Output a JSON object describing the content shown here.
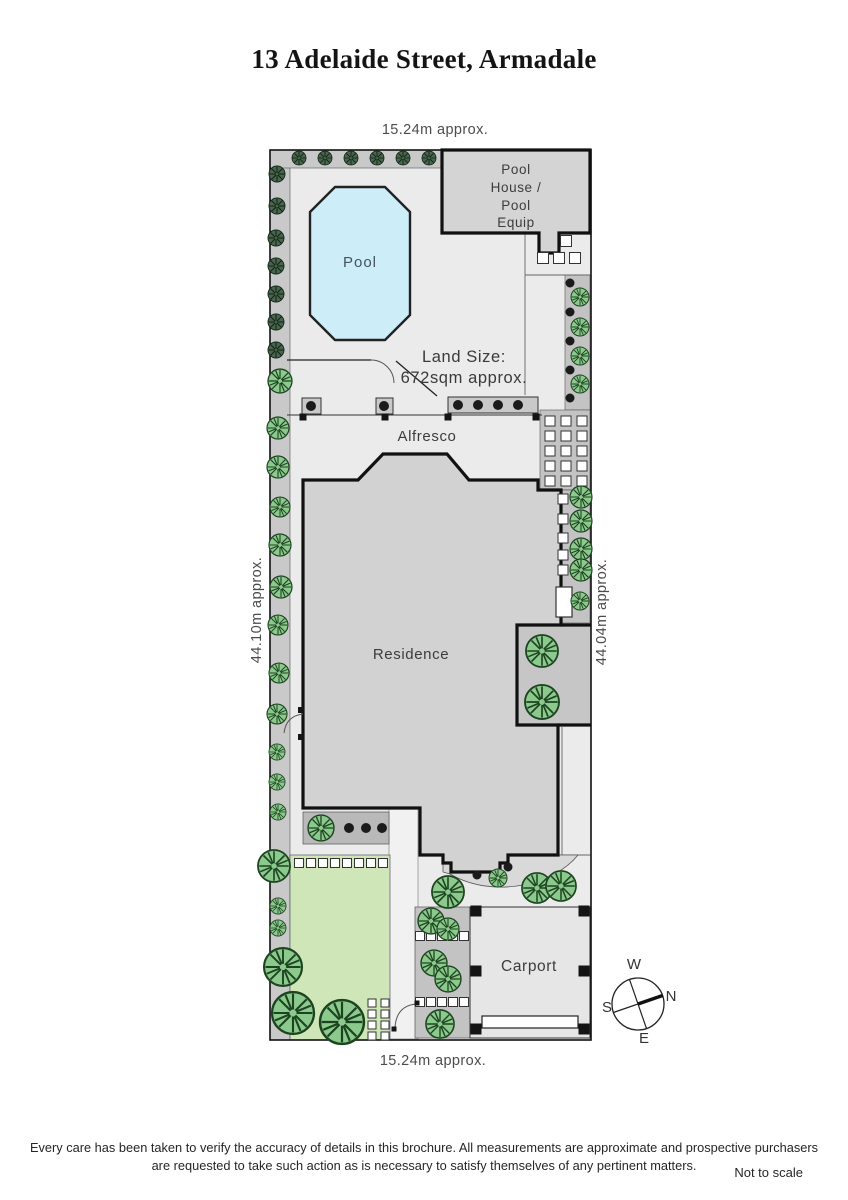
{
  "title": "13 Adelaide Street, Armadale",
  "dimensions": {
    "top": "15.24m approx.",
    "bottom": "15.24m approx.",
    "left": "44.10m approx.",
    "right": "44.04m approx."
  },
  "labels": {
    "pool": "Pool",
    "pool_house": "Pool\nHouse /\nPool\nEquip",
    "land_size": "Land Size:\n672sqm approx.",
    "alfresco": "Alfresco",
    "residence": "Residence",
    "carport": "Carport"
  },
  "compass": {
    "w": "W",
    "n": "N",
    "s": "S",
    "e": "E"
  },
  "footer": {
    "disclaimer": "Every care has been taken to verify the accuracy of details in this brochure.  All measurements are approximate and prospective purchasers\nare requested to take such action as is necessary to satisfy themselves of any pertinent matters.",
    "scale_note": "Not to scale"
  },
  "colors": {
    "ground": "#ebebeb",
    "boundary_strip": "#c9c9c9",
    "building": "#d2d2d2",
    "pool_water": "#cdeef8",
    "lawn": "#cfe6b8",
    "courtyard": "#c6c6c6",
    "garden_bed": "#b9b9b9",
    "tree_green": "#8cc98c",
    "tree_dark": "#49654e",
    "outline": "#111111"
  },
  "plan": {
    "trees": [
      [
        299,
        158,
        7,
        "d"
      ],
      [
        325,
        158,
        7,
        "d"
      ],
      [
        351,
        158,
        7,
        "d"
      ],
      [
        377,
        158,
        7,
        "d"
      ],
      [
        403,
        158,
        7,
        "d"
      ],
      [
        429,
        158,
        7,
        "d"
      ],
      [
        277,
        174,
        8,
        "d"
      ],
      [
        277,
        206,
        8,
        "d"
      ],
      [
        276,
        238,
        8,
        "d"
      ],
      [
        276,
        266,
        8,
        "d"
      ],
      [
        276,
        294,
        8,
        "d"
      ],
      [
        276,
        322,
        8,
        "d"
      ],
      [
        276,
        350,
        8,
        "d"
      ],
      [
        280,
        381,
        12,
        "g"
      ],
      [
        278,
        428,
        11,
        "g"
      ],
      [
        278,
        467,
        11,
        "g"
      ],
      [
        280,
        507,
        10,
        "g"
      ],
      [
        280,
        545,
        11,
        "g"
      ],
      [
        281,
        587,
        11,
        "g"
      ],
      [
        278,
        625,
        10,
        "g"
      ],
      [
        279,
        673,
        10,
        "g"
      ],
      [
        277,
        714,
        10,
        "g"
      ],
      [
        277,
        752,
        8,
        "g"
      ],
      [
        277,
        782,
        8,
        "g"
      ],
      [
        278,
        812,
        8,
        "g"
      ],
      [
        274,
        866,
        16,
        "g"
      ],
      [
        278,
        906,
        8,
        "g"
      ],
      [
        278,
        928,
        8,
        "g"
      ],
      [
        283,
        967,
        19,
        "g"
      ],
      [
        293,
        1013,
        21,
        "g"
      ],
      [
        342,
        1022,
        22,
        "g"
      ],
      [
        321,
        828,
        13,
        "g"
      ],
      [
        580,
        297,
        9,
        "g"
      ],
      [
        580,
        327,
        9,
        "g"
      ],
      [
        580,
        356,
        9,
        "g"
      ],
      [
        580,
        384,
        9,
        "g"
      ],
      [
        581,
        497,
        11,
        "g"
      ],
      [
        581,
        521,
        11,
        "g"
      ],
      [
        581,
        549,
        11,
        "g"
      ],
      [
        581,
        570,
        11,
        "g"
      ],
      [
        580,
        601,
        9,
        "g"
      ],
      [
        542,
        651,
        16,
        "g"
      ],
      [
        542,
        702,
        17,
        "g"
      ],
      [
        448,
        892,
        16,
        "g"
      ],
      [
        498,
        878,
        9,
        "g"
      ],
      [
        537,
        888,
        15,
        "g"
      ],
      [
        561,
        886,
        15,
        "g"
      ],
      [
        431,
        921,
        13,
        "g"
      ],
      [
        448,
        929,
        11,
        "g"
      ],
      [
        434,
        963,
        13,
        "g"
      ],
      [
        448,
        979,
        13,
        "g"
      ],
      [
        440,
        1024,
        14,
        "g"
      ]
    ],
    "dots": [
      [
        311,
        406,
        5
      ],
      [
        384,
        406,
        5
      ],
      [
        458,
        405,
        5
      ],
      [
        478,
        405,
        5
      ],
      [
        498,
        405,
        5
      ],
      [
        518,
        405,
        5
      ],
      [
        570,
        283,
        4.5
      ],
      [
        570,
        312,
        4.5
      ],
      [
        570,
        341,
        4.5
      ],
      [
        570,
        370,
        4.5
      ],
      [
        570,
        398,
        4.5
      ],
      [
        349,
        828,
        5
      ],
      [
        366,
        828,
        5
      ],
      [
        382,
        828,
        5
      ],
      [
        477,
        875,
        4.5
      ],
      [
        508,
        867,
        4.5
      ]
    ],
    "pavers": [
      [
        566,
        241,
        11
      ],
      [
        543,
        258,
        11
      ],
      [
        559,
        258,
        11
      ],
      [
        575,
        258,
        11
      ],
      [
        550,
        421,
        10
      ],
      [
        566,
        421,
        10
      ],
      [
        582,
        421,
        10
      ],
      [
        550,
        436,
        10
      ],
      [
        566,
        436,
        10
      ],
      [
        582,
        436,
        10
      ],
      [
        550,
        451,
        10
      ],
      [
        566,
        451,
        10
      ],
      [
        582,
        451,
        10
      ],
      [
        550,
        466,
        10
      ],
      [
        566,
        466,
        10
      ],
      [
        582,
        466,
        10
      ],
      [
        550,
        481,
        10
      ],
      [
        566,
        481,
        10
      ],
      [
        582,
        481,
        10
      ],
      [
        563,
        499,
        10
      ],
      [
        563,
        519,
        10
      ],
      [
        563,
        538,
        10
      ],
      [
        563,
        555,
        10
      ],
      [
        563,
        570,
        10
      ],
      [
        299,
        863,
        9
      ],
      [
        311,
        863,
        9
      ],
      [
        323,
        863,
        9
      ],
      [
        335,
        863,
        9
      ],
      [
        347,
        863,
        9
      ],
      [
        359,
        863,
        9
      ],
      [
        371,
        863,
        9
      ],
      [
        383,
        863,
        9
      ],
      [
        372,
        1003,
        8
      ],
      [
        385,
        1003,
        8
      ],
      [
        372,
        1014,
        8
      ],
      [
        385,
        1014,
        8
      ],
      [
        372,
        1025,
        8
      ],
      [
        385,
        1025,
        8
      ],
      [
        372,
        1036,
        8
      ],
      [
        385,
        1036,
        8
      ],
      [
        420,
        936,
        9
      ],
      [
        431,
        936,
        9
      ],
      [
        442,
        936,
        9
      ],
      [
        453,
        936,
        9
      ],
      [
        464,
        936,
        9
      ],
      [
        420,
        1002,
        9
      ],
      [
        431,
        1002,
        9
      ],
      [
        442,
        1002,
        9
      ],
      [
        453,
        1002,
        9
      ],
      [
        464,
        1002,
        9
      ]
    ],
    "posts": [
      [
        303,
        417,
        7
      ],
      [
        385,
        417,
        7
      ],
      [
        448,
        417,
        7
      ],
      [
        536,
        417,
        7
      ],
      [
        476,
        911,
        11
      ],
      [
        584,
        911,
        11
      ],
      [
        476,
        971,
        11
      ],
      [
        584,
        971,
        11
      ],
      [
        476,
        1029,
        11
      ],
      [
        584,
        1029,
        11
      ],
      [
        301,
        710,
        6
      ],
      [
        301,
        737,
        6
      ],
      [
        394,
        1029,
        5
      ],
      [
        417,
        1003,
        5
      ]
    ]
  }
}
